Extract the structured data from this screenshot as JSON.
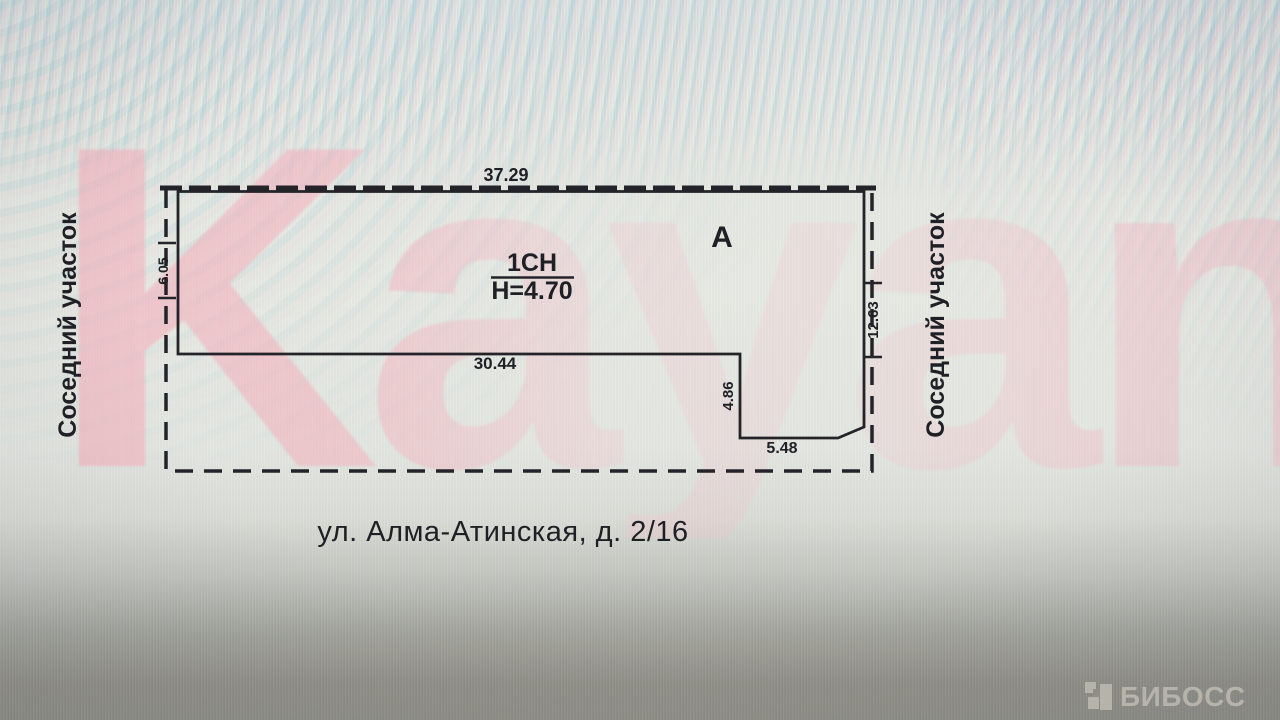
{
  "document": {
    "watermark": "Kayan",
    "plan": {
      "building_label": "А",
      "structure_label": "1СН",
      "height_label": "H=4.70",
      "dimensions": {
        "top": "37.29",
        "left": "6.05",
        "right": "12.63",
        "bottom_main": "30.44",
        "notch_height": "4.86",
        "notch_width": "5.48"
      },
      "neighbor_left": "Соседний участок",
      "neighbor_right": "Соседний участок"
    },
    "address": "ул. Алма-Атинская, д. 2/16"
  },
  "footer": {
    "logo_text": "БИБОСС"
  },
  "colors": {
    "line": "#232329",
    "watermark_pink": "#f3b6c0",
    "page_background": "#e6e9e3",
    "footer_background": "#8f8e87",
    "logo_gray": "#b6b3ab"
  }
}
